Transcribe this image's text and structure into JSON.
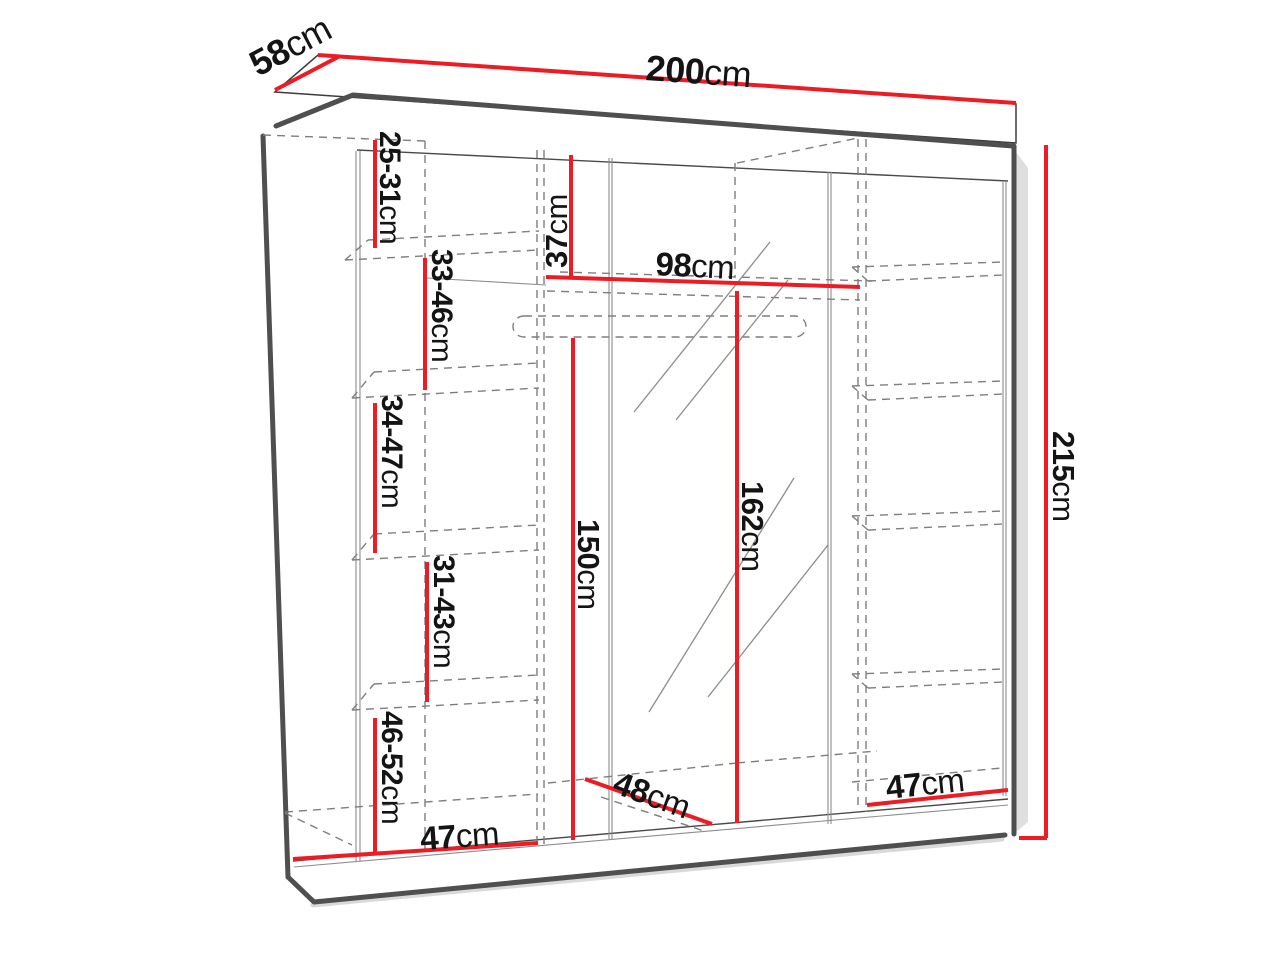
{
  "diagram": {
    "subject": "wardrobe-dimension-diagram",
    "colors": {
      "dimension": "#ed1c24",
      "structure_dark": "#4f4f4f",
      "structure_light": "#7e7e7e",
      "text": "#141414",
      "background": "#ffffff"
    },
    "dims": {
      "width": {
        "value": "200",
        "unit": "cm"
      },
      "depth": {
        "value": "58",
        "unit": "cm"
      },
      "height": {
        "value": "215",
        "unit": "cm"
      },
      "top_gap": {
        "value": "37",
        "unit": "cm"
      },
      "rail_width": {
        "value": "98",
        "unit": "cm"
      },
      "hang_left": {
        "value": "150",
        "unit": "cm"
      },
      "hang_right": {
        "value": "162",
        "unit": "cm"
      },
      "shelf_1": {
        "value": "25-31",
        "unit": "cm"
      },
      "shelf_2": {
        "value": "33-46",
        "unit": "cm"
      },
      "shelf_3": {
        "value": "34-47",
        "unit": "cm"
      },
      "shelf_4": {
        "value": "31-43",
        "unit": "cm"
      },
      "shelf_5": {
        "value": "46-52",
        "unit": "cm"
      },
      "floor_left": {
        "value": "47",
        "unit": "cm"
      },
      "floor_middle": {
        "value": "48",
        "unit": "cm"
      },
      "floor_right": {
        "value": "47",
        "unit": "cm"
      }
    }
  }
}
